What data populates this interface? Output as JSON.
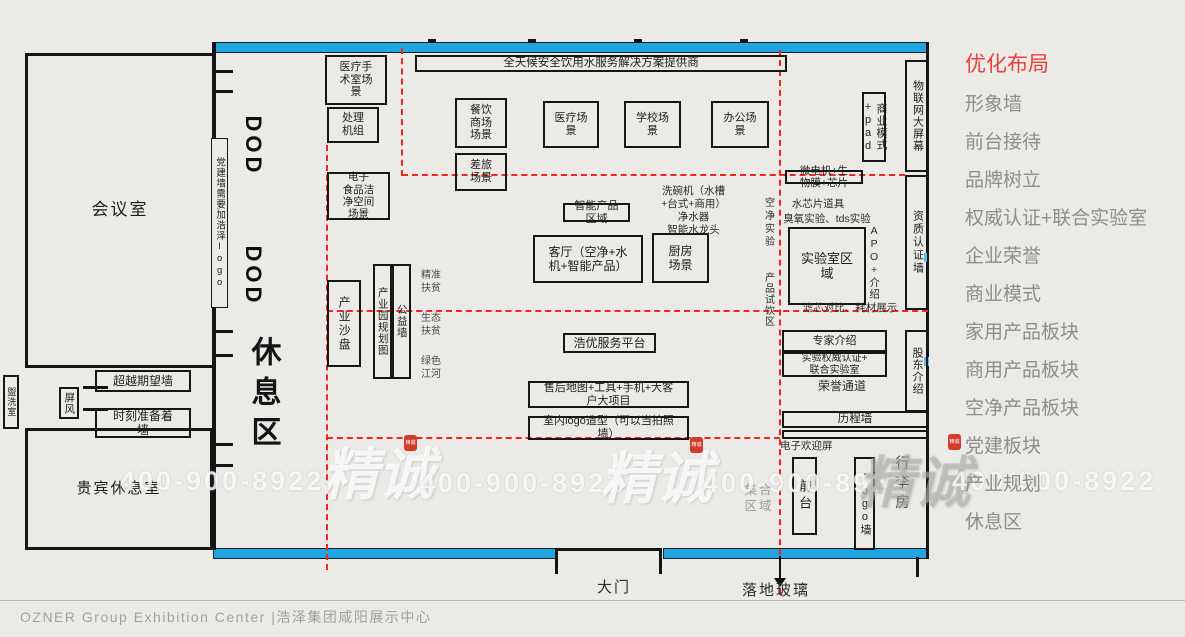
{
  "colors": {
    "accent_red": "#e8413c",
    "wall_blue": "#1fa6e0",
    "dashed_red": "#f3251d"
  },
  "sidebar": {
    "title": "优化布局",
    "items": [
      "形象墙",
      "前台接待",
      "品牌树立",
      "权威认证+联合实验室",
      "企业荣誉",
      "商业模式",
      "家用产品板块",
      "商用产品板块",
      "空净产品板块",
      "党建板块",
      "产业规划",
      "休息区"
    ]
  },
  "footer": {
    "text": "OZNER Group Exhibition Center |浩泽集团咸阳展示中心"
  },
  "watermark": {
    "brand": "精诚",
    "phone": "400-900-8922"
  },
  "plan": {
    "labels": {
      "banner": "全天候安全饮用水服务解决方案提供商",
      "meeting_room": "会议室",
      "vip_room": "贵宾休息室",
      "washroom": "盥洗室",
      "screen": "屏风",
      "exceed_wall": "超越期望墙",
      "ready_wall": "时刻准备着\n墙",
      "rest_area": "休息区",
      "party_note": "党建墙需要加浩泽logo",
      "dod": "DOD",
      "medical_surgery": "医疗手\n术室场\n景",
      "processing_unit": "处理\n机组",
      "e_food_clean": "电子\n食品洁\n净空间\n场景",
      "catering_mall": "餐饮\n商场\n场景",
      "travel": "差旅\n场景",
      "medical_scene": "医疗场\n景",
      "school_scene": "学校场\n景",
      "office_scene": "办公场\n景",
      "industry_sandbox": "产业沙盘",
      "industrial_park": "产业园规划图",
      "welfare_wall": "公益墙",
      "precise_poverty": "精准\n扶贫",
      "eco_poverty": "生态\n扶贫",
      "green_river": "绿色\n江河",
      "smart_area": "智能产品\n区域",
      "living_room": "客厅（空净+水\n机+智能产品）",
      "kitchen": "厨房\n场景",
      "dishwasher": "洗碗机（水槽\n+台式+商用）\n净水器\n智能水龙头",
      "haoyou": "浩优服务平台",
      "aftersale": "售后地图+工具+手机+大客\n户大项目",
      "indoor_logo": "室内logo造型（可以当拍照\n墙）",
      "biz_pad": "商业模式+pad",
      "iot_screen": "物联网大屏幕",
      "micromotor": "微电机+生\n物膜+芯片",
      "water_chip": "水芯片道具",
      "ozone": "臭氧实验、tds实验",
      "air_exp": "空净实验",
      "tasting": "产品试饮区",
      "lab_area": "实验室区\n域",
      "apo": "APO+介绍",
      "cert_wall": "资质认证墙",
      "filter_compare": "滤芯对比、耗材展示",
      "expert": "专家介绍",
      "auth_lab": "实验权威认证+\n联合实验室",
      "honor_channel": "荣誉通道",
      "shareholder": "股东介绍",
      "history_wall": "历程墙",
      "welcome_screen": "电子欢迎屏",
      "front_desk": "前台",
      "logo_wall": "logo墙",
      "luggage": "行李房",
      "gather_area": "集合\n区域",
      "gate": "大门",
      "glass": "落地玻璃"
    }
  }
}
